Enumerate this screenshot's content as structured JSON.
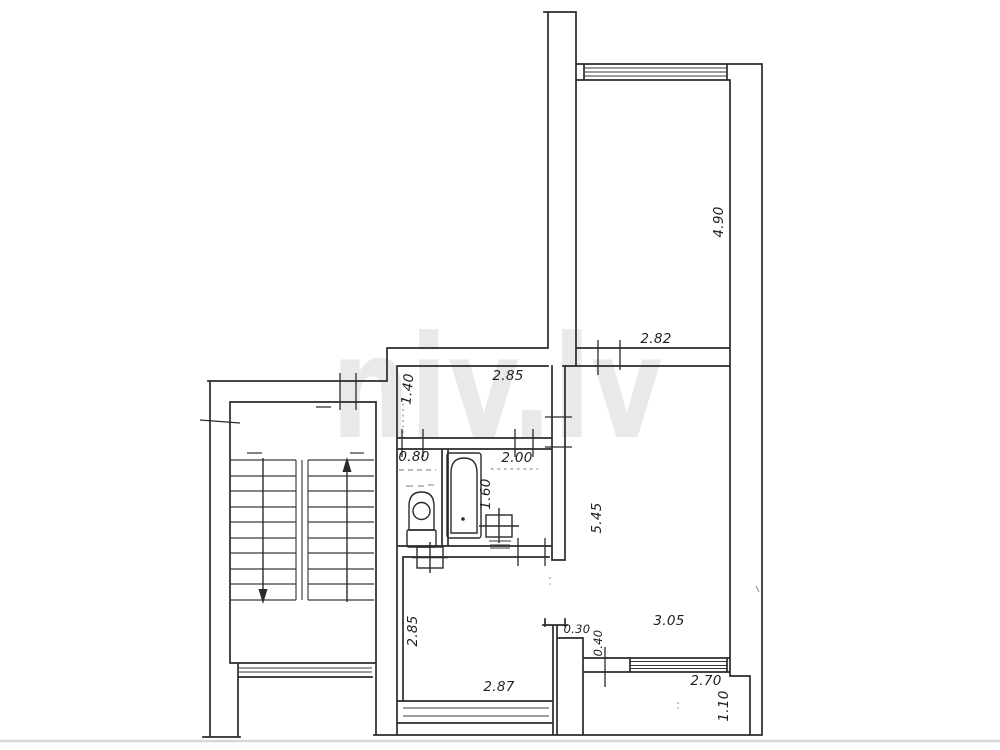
{
  "document": {
    "watermark": "niv.lv"
  },
  "colors": {
    "line": "#2b2b2b",
    "watermark": "#e9e9e9",
    "paper": "#ffffff",
    "scan_streak": "#c9c9c9"
  },
  "dims": [
    {
      "text": "4.90"
    },
    {
      "text": "2.82"
    },
    {
      "text": "2.85"
    },
    {
      "text": "1.40"
    },
    {
      "text": "0.80"
    },
    {
      "text": "2.00"
    },
    {
      "text": "1.60"
    },
    {
      "text": "5.45"
    },
    {
      "text": "2.85"
    },
    {
      "text": "3.05"
    },
    {
      "text": "0.30"
    },
    {
      "text": "0.40"
    },
    {
      "text": "2.87"
    },
    {
      "text": "2.70"
    },
    {
      "text": "1.10"
    }
  ],
  "fixtures": {
    "toilet": "toilet",
    "bathtub": "bathtub",
    "washbasin": "washbasin",
    "stove": "stove"
  },
  "stairs": {
    "flights": 2,
    "left_arrow": "down",
    "right_arrow": "up"
  }
}
